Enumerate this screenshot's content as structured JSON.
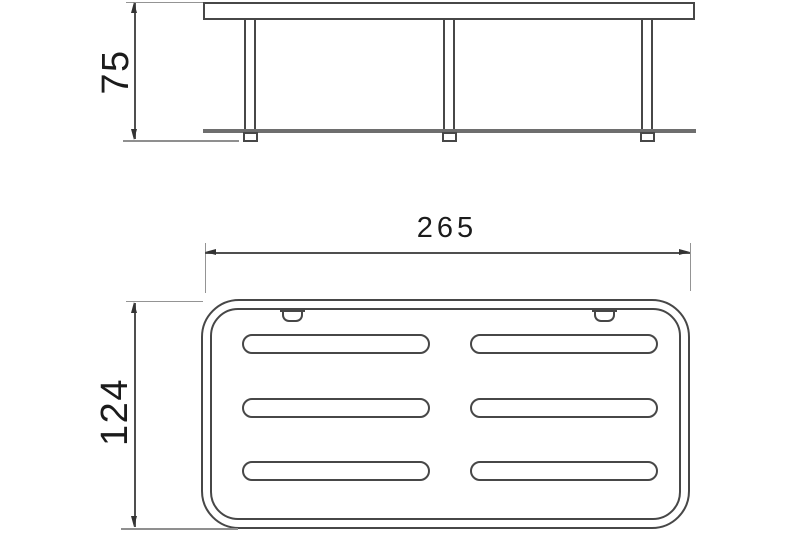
{
  "dimensions": {
    "side_height": "75",
    "plan_width": "265",
    "plan_depth": "124"
  },
  "colors": {
    "line": "#474747",
    "shelf_edge": "#6e6e6e",
    "dimension": "#4f4f4f",
    "extension": "#949494",
    "text": "#1b1b1b",
    "background": "#ffffff"
  }
}
